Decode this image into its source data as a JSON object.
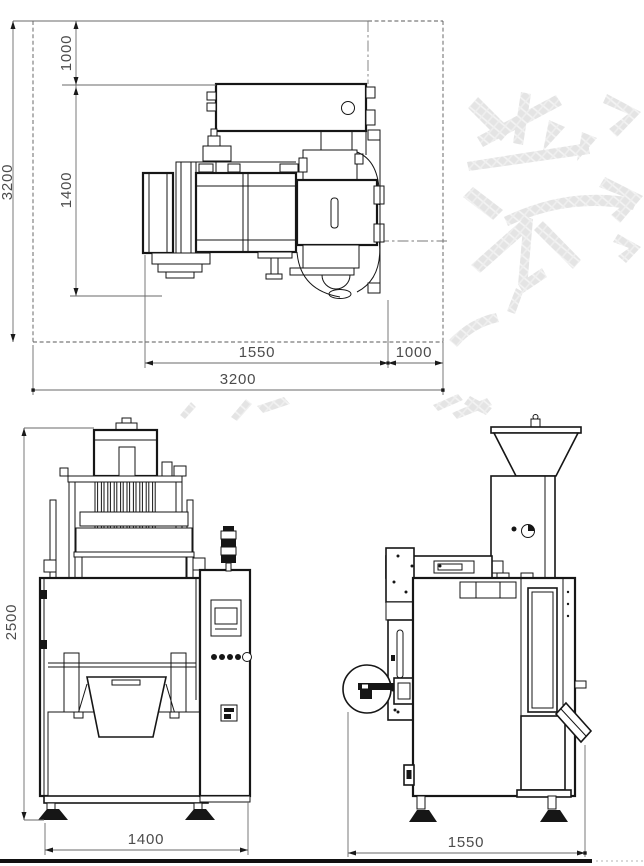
{
  "document_type": "engineering-drawing",
  "subject": "multi-lane vertical packaging machine, three orthographic views",
  "colors": {
    "background": "#ffffff",
    "line": "#161616",
    "dimension_line": "#6a6a6a",
    "dimension_text": "#4c4c4c",
    "watermark": "#e4e4e4",
    "bottom_bar": "#111111"
  },
  "views": {
    "top": {
      "label": "top-view",
      "dims": {
        "overall_height": "3200",
        "offset_top": "1000",
        "body_depth": "1400",
        "body_width": "1550",
        "offset_right": "1000",
        "overall_width": "3200"
      }
    },
    "front": {
      "label": "front-view",
      "dims": {
        "height": "2500",
        "width": "1400"
      }
    },
    "side": {
      "label": "side-view",
      "dims": {
        "depth": "1550"
      }
    }
  }
}
